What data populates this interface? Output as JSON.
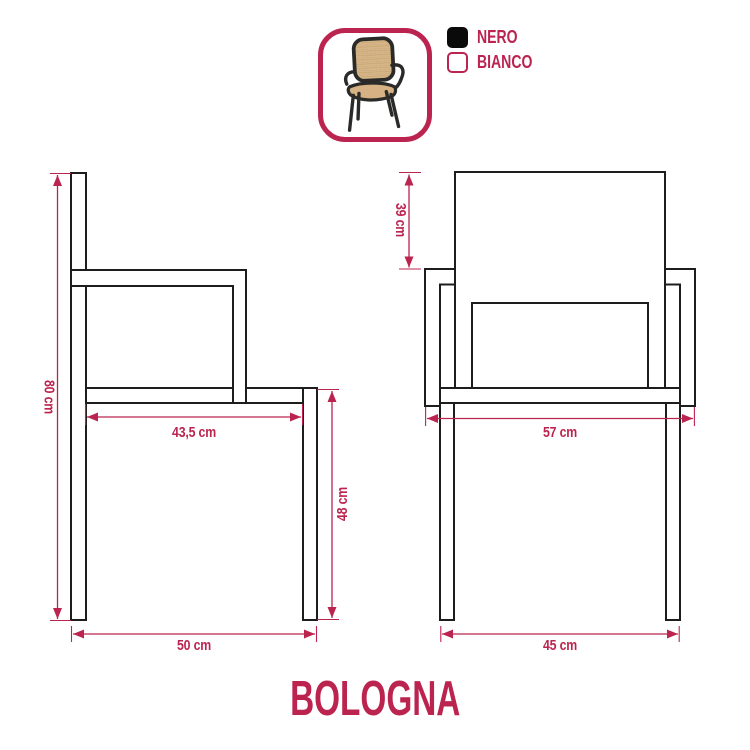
{
  "title": "BOLOGNA",
  "accent_color": "#BC2450",
  "line_color": "#1d1d1b",
  "legend": {
    "items": [
      {
        "label": "NERO",
        "color": "#0a0a0a"
      },
      {
        "label": "BIANCO",
        "color": "#ffffff"
      }
    ]
  },
  "product_photo": {
    "description": "armchair with black frame and rattan cane seat and backrest",
    "frame_color": "#2a2a28",
    "cane_color": "#d9b98c"
  },
  "views": {
    "side": {
      "dims": {
        "height": "80 cm",
        "seat_depth": "43,5 cm",
        "seat_height": "48 cm",
        "total_depth": "50 cm"
      }
    },
    "front": {
      "dims": {
        "backrest_height": "39 cm",
        "overall_width": "57 cm",
        "base_width": "45 cm"
      }
    }
  }
}
